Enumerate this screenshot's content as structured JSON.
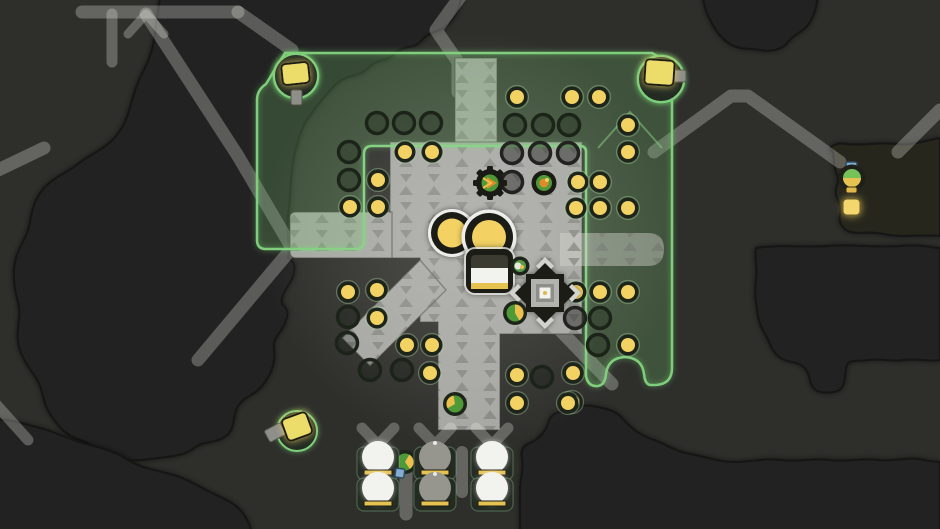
{
  "scene": {
    "label": "strategy-game-map-viewport",
    "width": 940,
    "height": 529
  },
  "palette": {
    "bg": "#2e2e2b",
    "blob": "#222220",
    "blobOlive": "#26261f",
    "blobEdge": "#141412",
    "road": "rgba(240,240,234,0.28)",
    "roadBright": "rgba(245,245,240,0.34)",
    "platform": "#a6a6a2",
    "platformBright": "#b7b7b3",
    "platformMark": "#6e6e6a",
    "platformEdge": "rgba(55,55,50,0.45)",
    "greenFill": "rgba(112,180,104,0.27)",
    "greenLine": "#7fce7c",
    "greenSoft": "rgba(140,212,134,0.5)",
    "yellow": "#f3d264",
    "yellowDeep": "#e6c350",
    "ringDark": "#1d241a",
    "ringPlat": "#222222",
    "paleRing": "rgba(165,205,155,0.4)",
    "white": "#f2f2ee",
    "domeBase": "#242b22",
    "domeGray": "#96968f",
    "unitGreen": "#4f9a38",
    "unitOrange": "#e08a2c",
    "unitYellow": "#ecc04e",
    "scoutGreen": "#74c258",
    "blue": "#84aed0",
    "blueEdge": "#2f4a60",
    "dark": "#1b1b16",
    "inner": "#b2b2ae",
    "stem": "#8e8e8a",
    "lampYellow": "#ecdc6a"
  },
  "terrain": {
    "blobs": [
      {
        "name": "terrain-dark-patch-left",
        "fill": "#222220",
        "d": "M 162,-12 L 462,-12 C 462,2 458,14 448,24 C 438,34 430,30 422,40 C 414,50 404,44 394,54 C 386,62 378,58 368,68 C 358,78 346,74 336,84 C 326,94 318,104 308,118 C 300,130 296,146 293,162 C 290,178 291,196 288,214 C 286,232 290,244 288,258 Q 296,262 294,272 C 292,286 280,290 282,304 Q 290,310 286,320 C 282,334 272,336 274,350 C 276,364 270,376 262,386 C 254,396 244,396 238,406 C 232,416 236,428 226,436 C 216,444 204,440 194,448 C 184,456 172,456 158,458 C 144,460 130,462 116,458 C 102,454 94,444 80,440 C 66,436 58,426 50,414 C 42,402 44,390 36,378 C 28,366 20,356 18,342 C 16,328 22,316 18,302 C 14,288 12,272 16,258 C 20,244 28,236 30,222 C 32,208 36,196 46,186 C 56,176 68,172 78,164 C 88,156 98,152 108,144 C 118,136 124,126 128,114 C 132,102 134,90 140,78 C 146,66 152,54 154,40 C 156,26 158,8 162,-12 Z"
      },
      {
        "name": "terrain-dark-patch-topright",
        "fill": "#222220",
        "d": "M 702,-12 L 818,-12 C 818,0 816,12 810,22 C 804,32 794,34 788,42 C 782,50 770,52 760,50 C 750,48 740,50 730,44 C 720,38 714,28 708,16 C 704,6 702,-2 702,-12 Z"
      },
      {
        "name": "terrain-dark-patch-right-band",
        "fill": "#26261f",
        "d": "M 940,138 L 940,236 C 920,234 900,238 884,234 C 868,230 856,236 846,230 Q 838,224 840,214 C 842,202 834,198 836,188 Q 840,180 836,172 C 832,162 836,154 830,148 Q 836,142 846,144 C 862,146 880,142 896,144 C 912,146 928,140 940,138 Z"
      },
      {
        "name": "terrain-dark-patch-right",
        "fill": "#232321",
        "d": "M 756,248 C 780,244 804,248 828,246 C 852,244 876,248 900,246 C 920,244 932,248 940,248 L 940,360 C 928,362 916,358 904,360 C 892,362 880,358 868,360 C 856,362 848,358 846,368 C 844,380 846,390 834,392 C 822,394 812,392 810,380 C 808,370 804,364 792,362 C 780,360 774,354 770,344 C 766,334 760,328 758,316 C 756,304 754,292 756,280 C 758,268 754,258 756,248 Z"
      },
      {
        "name": "terrain-dark-patch-bottomleft",
        "fill": "#222220",
        "d": "M -12,420 C 8,418 24,424 40,428 C 56,432 70,440 86,444 C 102,448 116,452 128,460 C 140,468 156,470 170,474 C 186,478 198,486 210,492 C 222,498 234,502 242,512 C 248,520 252,528 252,540 L -12,540 Z"
      },
      {
        "name": "terrain-dark-patch-bottomright",
        "fill": "#232321",
        "d": "M 520,540 L 520,490 C 520,478 524,470 522,458 Q 520,448 528,444 C 538,440 544,434 548,424 Q 550,414 560,412 C 572,410 580,404 592,406 C 604,408 616,410 624,420 C 632,430 642,436 654,440 C 666,444 676,452 690,454 C 704,456 718,462 734,462 C 750,462 766,458 782,460 C 798,462 814,458 830,460 C 846,462 862,458 878,460 C 894,462 910,456 924,460 C 934,462 940,462 940,462 L 940,540 Z"
      }
    ]
  },
  "roads": [
    {
      "name": "road-top-horizontal",
      "d": "M 82,12 H 238",
      "w": 13
    },
    {
      "name": "road-top-fork",
      "d": "M 238,12 L 292,50",
      "w": 13
    },
    {
      "name": "road-trestle",
      "d": "M 146,14 L 128,34 M 146,14 L 164,34",
      "w": 9
    },
    {
      "name": "road-left-vertical",
      "d": "M 112,14 V 62",
      "w": 11
    },
    {
      "name": "road-long-diagonal",
      "d": "M 146,14 L 238,156 L 292,248 L 198,360",
      "w": 13
    },
    {
      "name": "road-left-edge",
      "d": "M -6,172 L 44,148",
      "w": 13
    },
    {
      "name": "road-top-zigzag",
      "d": "M 462,-6 L 436,30 L 458,62 L 458,92",
      "w": 13
    },
    {
      "name": "road-right-chevron",
      "d": "M 654,152 L 731,96 H 748 L 840,162",
      "w": 13
    },
    {
      "name": "road-right-corner",
      "d": "M 898,152 L 940,110",
      "w": 13
    },
    {
      "name": "road-south-east",
      "d": "M 556,326 L 612,384",
      "w": 13
    },
    {
      "name": "road-bottomleft-diag",
      "d": "M -6,402 L 28,440",
      "w": 11
    }
  ],
  "platform": {
    "parts": [
      {
        "name": "platform-top-stub",
        "d": "M 455,58 h 42 v 88 h -42 Z"
      },
      {
        "name": "platform-main",
        "d": "M 390,142 H 582 V 334 H 500 V 430 H 438 V 322 H 420 V 258 H 390 Z"
      },
      {
        "name": "platform-left-arm",
        "d": "M 296,212 H 392 V 258 H 296 Q 290,258 290,252 V 218 Q 290,212 296,212 Z"
      },
      {
        "name": "platform-diagonal-arm",
        "d": "M 420,260 L 342,338 L 370,366 L 446,290 Z"
      }
    ],
    "bridge": {
      "name": "platform-bridge-arm",
      "d": "M 560,233 H 648 Q 664,233 664,249 Q 664,266 648,266 H 560 Z"
    }
  },
  "green_zone": {
    "outline": "M 285,53 L 652,53 L 668,62 Q 672,66 672,74 L 672,368 Q 672,384 656,385 L 651,385 Q 645,385 644,374 Q 642,358 625,357 Q 608,358 606,374 Q 605,385 598,386 Q 588,387 586,376 L 586,152 Q 586,146 580,146 L 372,146 Q 364,146 364,154 L 364,240 Q 364,249 356,249 L 266,249 Q 257,249 257,240 L 257,100 Q 257,90 266,84 Z",
    "bulges": [
      {
        "name": "coverage-bulge-left",
        "cx": 296,
        "cy": 76,
        "r": 22
      },
      {
        "name": "coverage-bulge-right",
        "cx": 661,
        "cy": 79,
        "r": 23
      }
    ],
    "chevron": "M 598,148 L 630,112 L 662,148"
  },
  "dots": {
    "filled": [
      [
        517,
        97
      ],
      [
        572,
        97
      ],
      [
        599,
        97
      ],
      [
        628,
        125
      ],
      [
        628,
        152
      ],
      [
        578,
        182
      ],
      [
        600,
        182
      ],
      [
        576,
        208
      ],
      [
        600,
        208
      ],
      [
        628,
        208
      ],
      [
        405,
        152
      ],
      [
        432,
        152
      ],
      [
        378,
        180
      ],
      [
        350,
        207
      ],
      [
        378,
        207
      ],
      [
        576,
        292
      ],
      [
        600,
        292
      ],
      [
        628,
        292
      ],
      [
        628,
        345
      ],
      [
        573,
        373
      ],
      [
        572,
        402
      ],
      [
        348,
        292
      ],
      [
        377,
        290
      ],
      [
        377,
        318
      ],
      [
        407,
        345
      ],
      [
        432,
        345
      ],
      [
        430,
        373
      ],
      [
        517,
        375
      ],
      [
        517,
        403
      ],
      [
        568,
        403
      ]
    ],
    "empty": [
      [
        377,
        123
      ],
      [
        404,
        123
      ],
      [
        431,
        123
      ],
      [
        349,
        152
      ],
      [
        349,
        180
      ],
      [
        515,
        125
      ],
      [
        543,
        125
      ],
      [
        569,
        125
      ],
      [
        600,
        318
      ],
      [
        598,
        345
      ],
      [
        348,
        317
      ],
      [
        347,
        343
      ],
      [
        370,
        370
      ],
      [
        402,
        370
      ],
      [
        542,
        377
      ]
    ],
    "empty_platform": [
      [
        512,
        153
      ],
      [
        540,
        153
      ],
      [
        568,
        153
      ],
      [
        512,
        182
      ],
      [
        575,
        318
      ]
    ]
  },
  "connectors": [
    {
      "name": "hut-junction",
      "d": "M 362,428 L 378,445 L 394,428 M 378,445 V 454",
      "w": 11
    },
    {
      "name": "hut-junction",
      "d": "M 419,428 L 435,445 L 451,428 M 435,445 V 454",
      "w": 11
    },
    {
      "name": "hut-junction",
      "d": "M 476,428 L 492,445 L 508,428 M 492,445 V 454",
      "w": 11
    },
    {
      "name": "hut-stub",
      "d": "M 406,466 V 514",
      "w": 13
    },
    {
      "name": "hut-stub",
      "d": "M 462,452 V 492",
      "w": 12
    }
  ],
  "storage": {
    "tank_left": {
      "cx": 452,
      "cy": 233,
      "rOuter": 24,
      "rRing": 21,
      "rCore": 14.5
    },
    "tank_right": {
      "cx": 489,
      "cy": 237,
      "rOuter": 27.5,
      "rRing": 24,
      "rCore": 17
    },
    "container": {
      "x": 466,
      "y": 249,
      "w": 47,
      "h": 44,
      "whiteY": 268,
      "whiteH": 15,
      "barY": 283,
      "barH": 6
    },
    "node": {
      "cx": 520,
      "cy": 266
    }
  },
  "octagon": {
    "cx": 545,
    "cy": 293,
    "tip": 27,
    "bodyHalf": 30,
    "innerHalf": 14,
    "coreHalf": 5.5
  },
  "units": [
    {
      "name": "turret-gear",
      "kind": "gear",
      "x": 490,
      "y": 183
    },
    {
      "name": "turret-pod",
      "kind": "pod",
      "x": 544,
      "y": 183
    },
    {
      "name": "worker-unit",
      "kind": "worker",
      "x": 515,
      "y": 313,
      "wedge": "M515,313 L515,304.5 A8.5 8.5 0 0 1 519.3,320.4 Z"
    },
    {
      "name": "worker-unit",
      "kind": "worker",
      "x": 455,
      "y": 404,
      "wedge": "M455,404 L447.6,408.3 A8.5 8.5 0 0 1 453.5,395.6 Z"
    },
    {
      "name": "worker-unit",
      "kind": "worker",
      "x": 405,
      "y": 462,
      "wedge": "M405,462 L409.3,454.6 A8.5 8.5 0 0 1 409.9,469 Z"
    }
  ],
  "blue_crate": {
    "x": 396,
    "y": 468,
    "s": 9,
    "rot": 8
  },
  "scout": {
    "cx": 852,
    "cy": 178,
    "r": 13.5,
    "cap": {
      "x": 846,
      "y": 162,
      "w": 11,
      "h": 8
    },
    "tab": {
      "x": 846,
      "y": 187,
      "w": 11,
      "h": 6
    }
  },
  "glow_square": {
    "x": 843,
    "y": 199,
    "w": 17,
    "h": 16
  },
  "lamps": [
    {
      "name": "lamp-post",
      "cx": 296,
      "cy": 76,
      "r": 22,
      "sq": [
        282,
        63,
        27,
        21,
        -6
      ],
      "stem": [
        291,
        90,
        11,
        15,
        0
      ]
    },
    {
      "name": "lamp-post",
      "cx": 661,
      "cy": 79,
      "r": 23,
      "sq": [
        645,
        60,
        29,
        25,
        4
      ],
      "stem": [
        671,
        70,
        15,
        12,
        0
      ]
    },
    {
      "name": "lamp-post",
      "cx": 297,
      "cy": 431,
      "r": 20,
      "sq": [
        284,
        415,
        26,
        23,
        -20
      ],
      "stem": [
        266,
        426,
        18,
        13,
        -28
      ]
    }
  ],
  "domes": [
    [
      378,
      447,
      1
    ],
    [
      435,
      447,
      0
    ],
    [
      492,
      447,
      1
    ],
    [
      378,
      478,
      1
    ],
    [
      435,
      478,
      0
    ],
    [
      492,
      478,
      1
    ]
  ]
}
